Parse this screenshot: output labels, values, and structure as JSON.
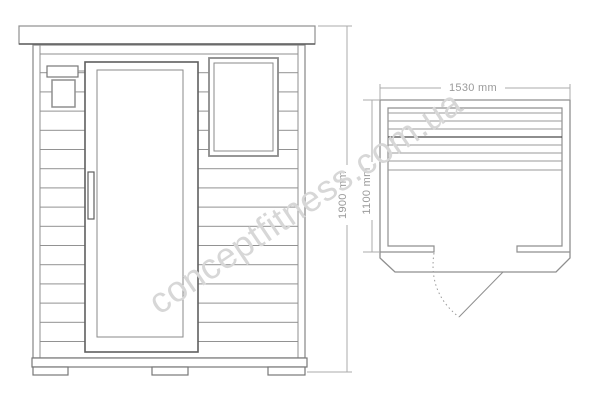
{
  "drawing": {
    "type": "sauna cabin technical drawing, front elevation and top plan",
    "front_view": {
      "height_dimension": "1900 mm"
    },
    "plan_view": {
      "width_dimension": "1530 mm",
      "depth_dimension": "1100 mm"
    },
    "watermark": "conceptfitness.com.ua"
  },
  "colors": {
    "background": "#ffffff",
    "line_main": "#8f8f8f",
    "line_dark": "#5f5f5f",
    "line_dimension": "#ababab",
    "dimension_text": "#9a9a9a",
    "watermark_text": "#d7d7d7",
    "bench_accent_line": "#4a4a4a"
  }
}
